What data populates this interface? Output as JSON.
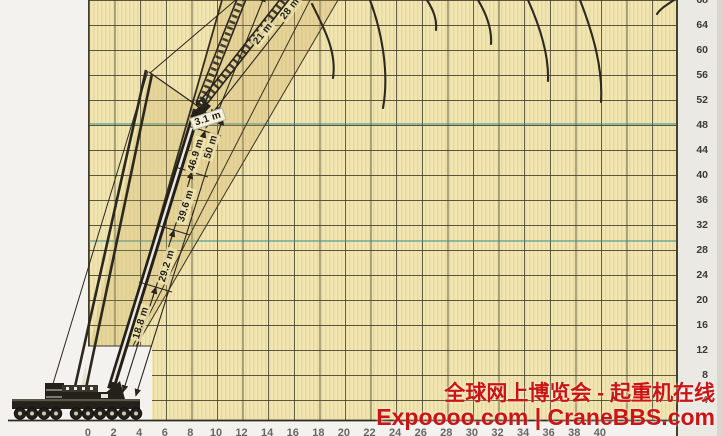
{
  "axes": {
    "height_labels": [
      "68",
      "64",
      "60",
      "56",
      "52",
      "48",
      "44",
      "40",
      "36",
      "32",
      "28",
      "24",
      "20",
      "16",
      "12",
      "8",
      "4"
    ],
    "radius_labels": [
      "0",
      "2",
      "4",
      "6",
      "8",
      "10",
      "12",
      "14",
      "16",
      "18",
      "20",
      "22",
      "24",
      "26",
      "28",
      "30",
      "32",
      "34",
      "36",
      "38",
      "40"
    ]
  },
  "dimensions": {
    "d188": "18.8 m",
    "d292": "29.2 m",
    "d396": "39.6 m",
    "d469": "46.9 m",
    "d50": "50 m",
    "d31": "3.1 m",
    "jib21": "21 m",
    "jib28": "28 m"
  },
  "watermark": {
    "line1": "全球网上博览会 - 起重机在线",
    "line2": "Expoooo.com | CraneBBS.com",
    "color": "#cc1414"
  },
  "colors": {
    "paper": "#f1e5b0",
    "grid": "#46412f",
    "ink": "#28261e",
    "teal": "#2e8f8a"
  },
  "chart_data": {
    "type": "line",
    "title": "Crane working range diagram (height vs. radius)",
    "y_axis_ticks": [
      4,
      8,
      12,
      16,
      20,
      24,
      28,
      32,
      36,
      40,
      44,
      48,
      52,
      56,
      60,
      64,
      68
    ],
    "boom_section_lengths_m": [
      18.8,
      29.2,
      39.6,
      46.9,
      50
    ],
    "boom_head_offset_m": 3.1,
    "jib_lengths_m": [
      21,
      28
    ],
    "curve_count": 8,
    "legend_position": "none",
    "grid": true
  }
}
